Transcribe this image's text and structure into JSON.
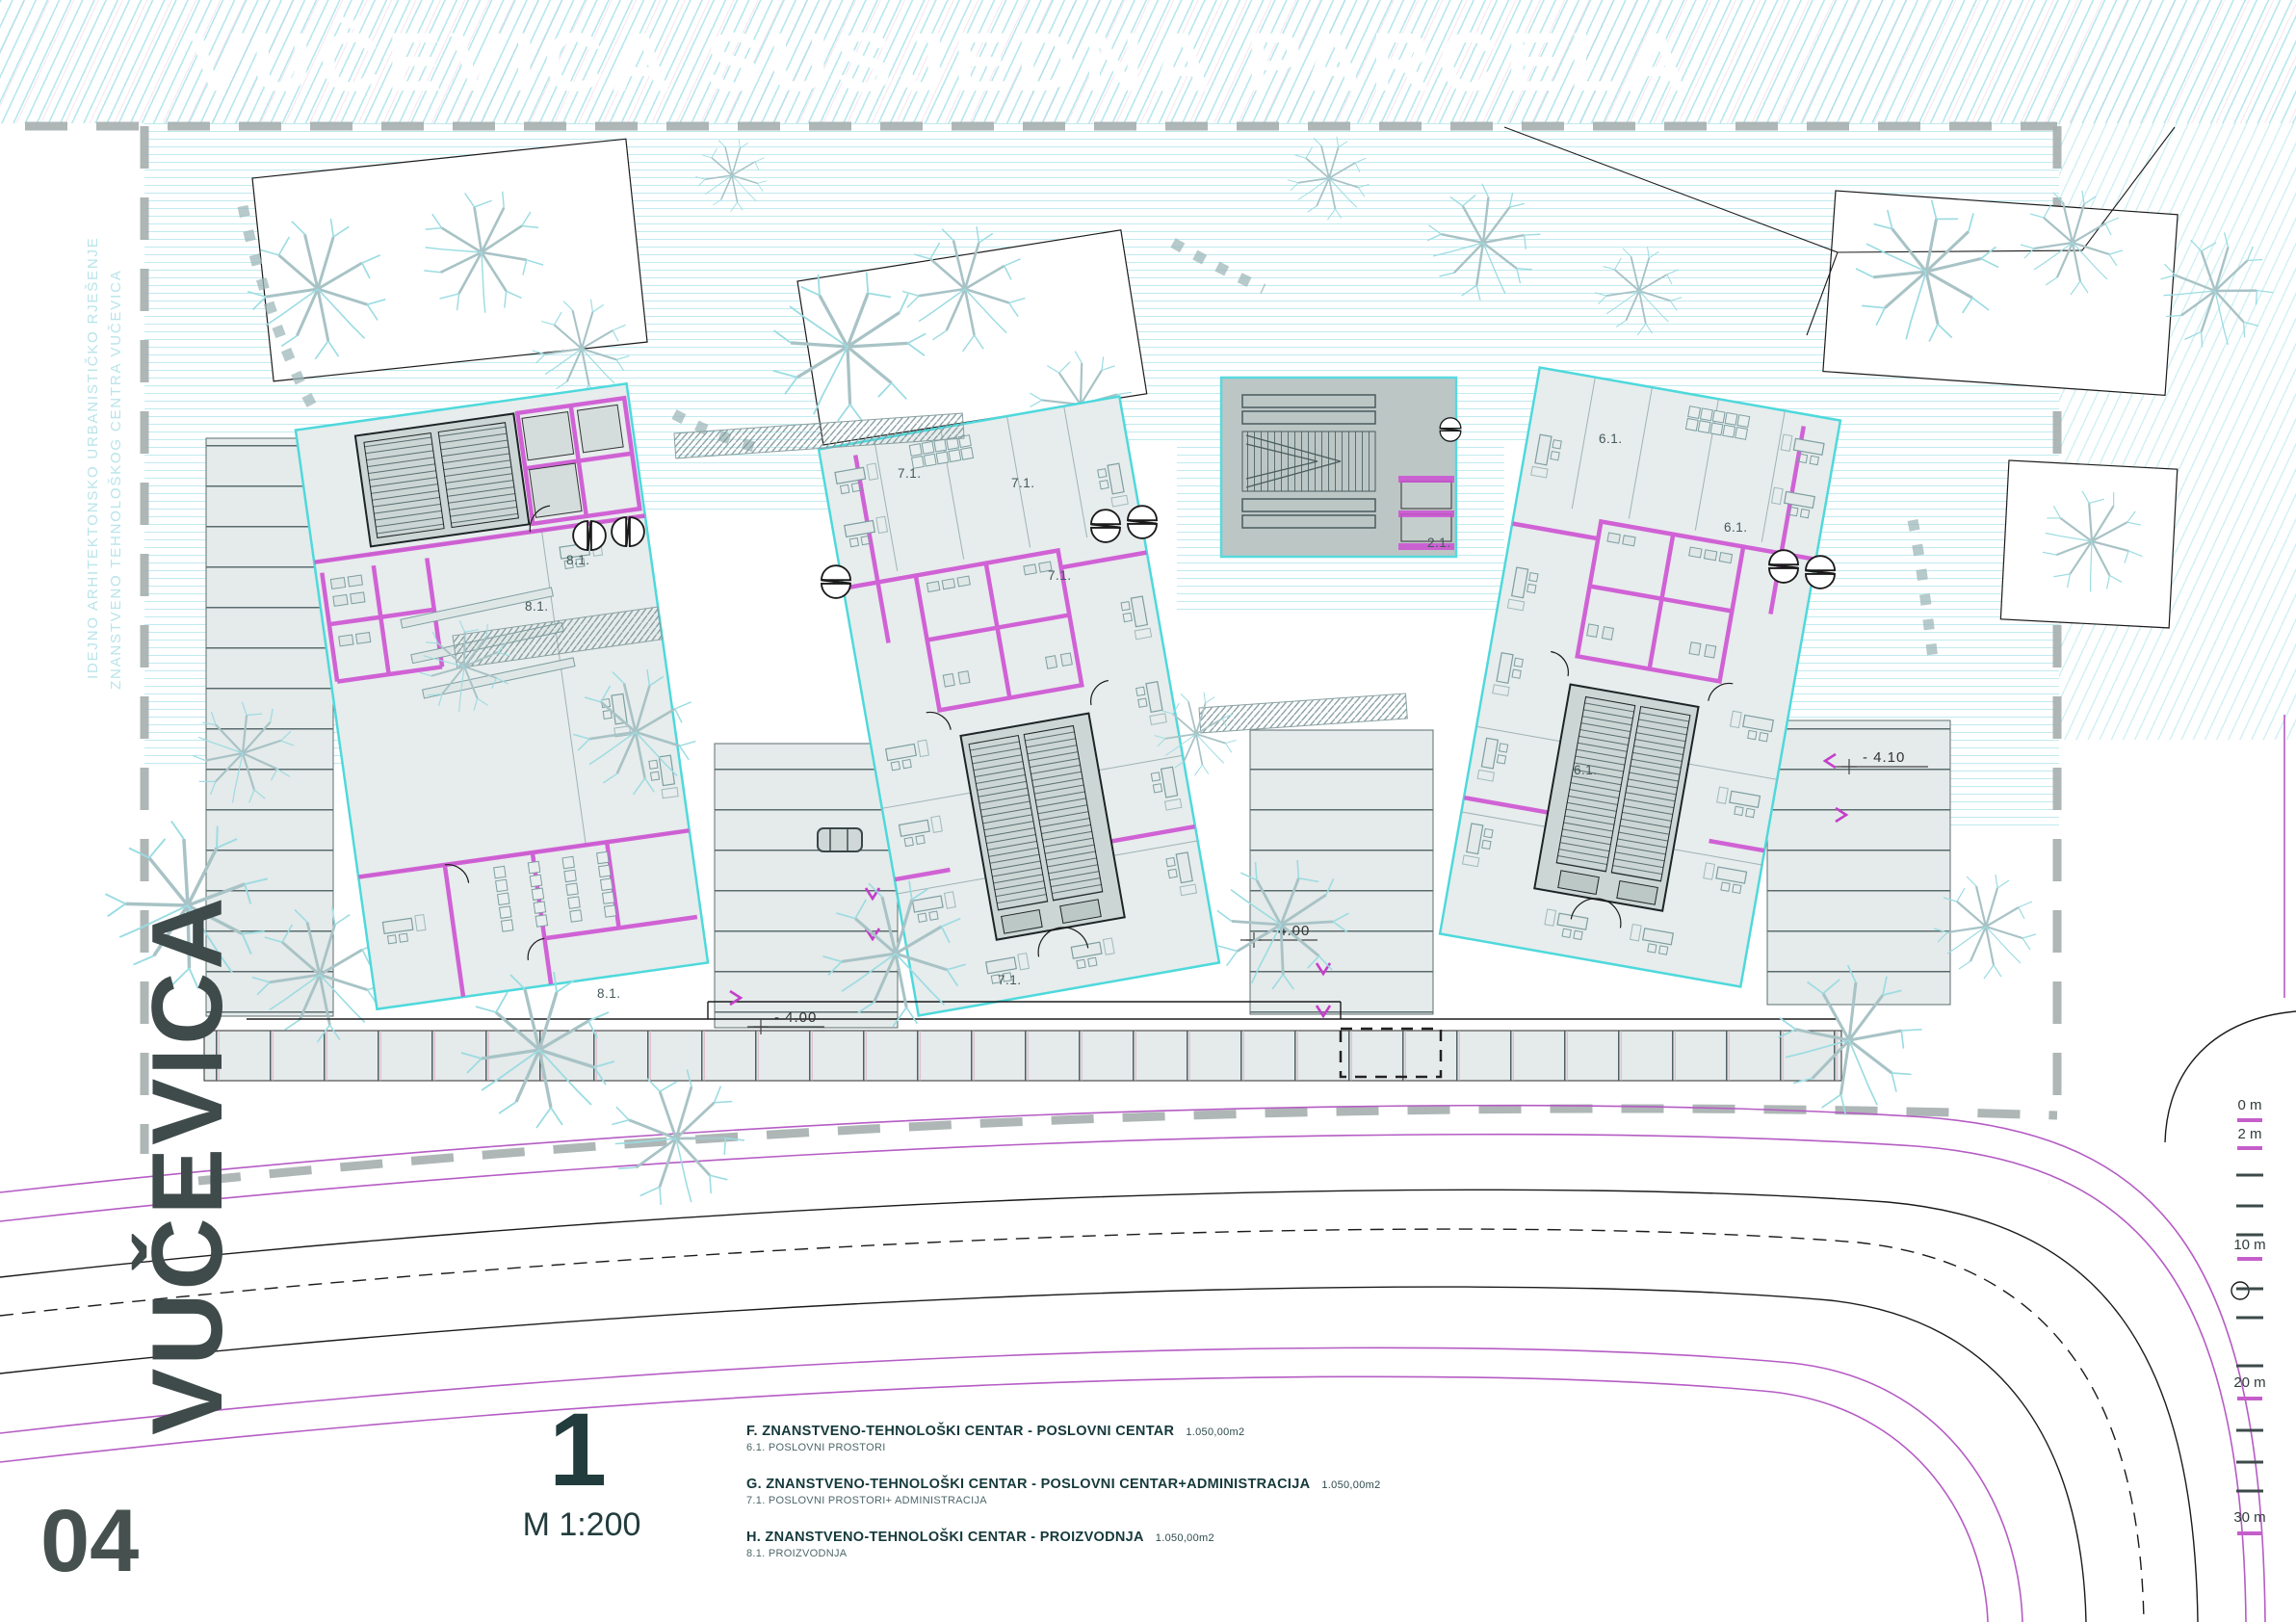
{
  "sheet": {
    "neighbor_parcel_title": "VUČEVICA SUSJEDNA PARCELA",
    "street_name": "VUČEVICA",
    "sheet_number": "04",
    "watermark_line_1": "IDEJNO ARHITEKTONSKO URBANISTIČKO RJEŠENJE",
    "watermark_line_2": "ZNANSTVENO TEHNOLOŠKOG CENTRA VUČEVICA"
  },
  "legend": {
    "figure_number": "1",
    "scale_label": "M 1:200",
    "entries": [
      {
        "title": "F. ZNANSTVENO-TEHNOLOŠKI CENTAR - POSLOVNI CENTAR",
        "area": "1.050,00m2",
        "subtitle": "6.1. POSLOVNI PROSTORI"
      },
      {
        "title": "G. ZNANSTVENO-TEHNOLOŠKI CENTAR - POSLOVNI CENTAR+ADMINISTRACIJA",
        "area": "1.050,00m2",
        "subtitle": "7.1. POSLOVNI PROSTORI+ ADMINISTRACIJA"
      },
      {
        "title": "H. ZNANSTVENO-TEHNOLOŠKI CENTAR - PROIZVODNJA",
        "area": "1.050,00m2",
        "subtitle": "8.1. PROIZVODNJA"
      }
    ]
  },
  "plan_labels": {
    "unit_f": "6.1.",
    "unit_g": "7.1.",
    "unit_h": "8.1.",
    "stair_plaza": "2.1.",
    "elevation_minus_410": "- 4.10",
    "elevation_minus_400": "- 4.00"
  },
  "scale_bar": {
    "labels": [
      "0 m",
      "2 m",
      "10 m",
      "20 m",
      "30 m"
    ]
  },
  "colors": {
    "accent_magenta": "#cd4fd2",
    "outline_cyan": "#4ed9dc",
    "hatch_cyan": "#8ed8e2",
    "ink": "#30403f"
  }
}
